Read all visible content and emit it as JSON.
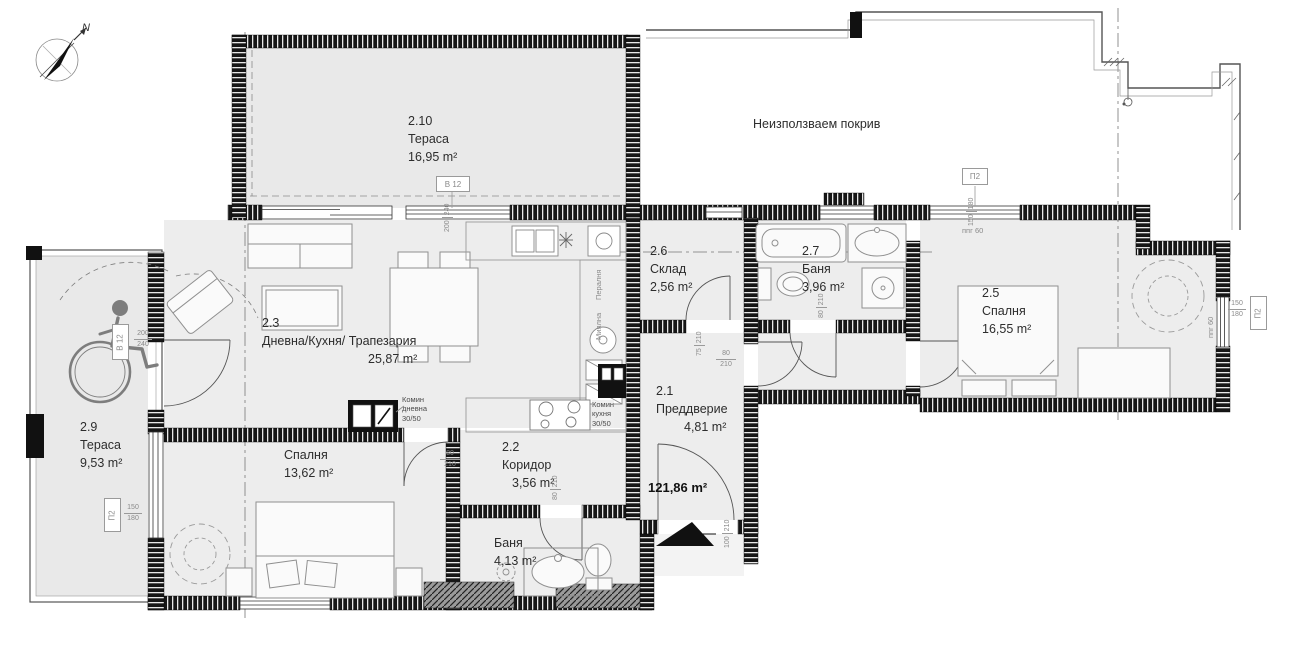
{
  "compass": {
    "north": "N"
  },
  "roof_label": "Неизползваем покрив",
  "total_area": "121,86 m²",
  "rooms": {
    "terrace_210": {
      "number": "2.10",
      "name": "Тераса",
      "area": "16,95 m²"
    },
    "living": {
      "number": "2.3",
      "name": "Дневна/Кухня/ Трапезария",
      "area": "25,87  m²"
    },
    "storage": {
      "number": "2.6",
      "name": "Склад",
      "area": "2,56 m²"
    },
    "bath_upper": {
      "number": "2.7",
      "name": "Баня",
      "area": "3,96 m²"
    },
    "bedroom_right": {
      "number": "2.5",
      "name": "Спалня",
      "area": "16,55 m²"
    },
    "entry": {
      "number": "2.1",
      "name": "Преддверие",
      "area": "4,81 m²"
    },
    "corridor": {
      "number": "2.2",
      "name": "Коридор",
      "area": "3,56 m²"
    },
    "bedroom_left": {
      "name": "Спалня",
      "area": "13,62 m²"
    },
    "bath_lower": {
      "name": "Баня",
      "area": "4,13 m²"
    },
    "terrace_29": {
      "number": "2.9",
      "name": "Тераса",
      "area": "9,53 m²"
    }
  },
  "chimneys": {
    "living": {
      "title": "Комин",
      "sub": "дневна",
      "size": "30/50"
    },
    "kitchen": {
      "title": "Комин",
      "sub": "кухня",
      "size": "30/50"
    }
  },
  "appliances": {
    "washer": "Пералня",
    "dishwasher": "Миялна"
  },
  "markers": {
    "b12_top": {
      "label": "B 12",
      "w": "200",
      "h": "240"
    },
    "b12_left": {
      "label": "B 12",
      "w": "200",
      "h": "240"
    },
    "p2_top": {
      "label": "П2",
      "w": "150",
      "h": "180"
    },
    "p2_right": {
      "label": "П2",
      "w": "150",
      "h": "180"
    },
    "p2_left": {
      "label": "П2",
      "w": "150",
      "h": "180"
    },
    "parapet_top": "ппг 60",
    "parapet_right": "ппг 60"
  },
  "doors": {
    "storage": {
      "w": "75",
      "h": "210"
    },
    "bath_upper": {
      "w": "80",
      "h": "210"
    },
    "bedroom_right": {
      "w": "80",
      "h": "210"
    },
    "bedroom_left": {
      "w": "80",
      "h": "210"
    },
    "bath_lower": {
      "w": "80",
      "h": "210"
    },
    "entrance": {
      "w": "100",
      "h": "210"
    }
  }
}
